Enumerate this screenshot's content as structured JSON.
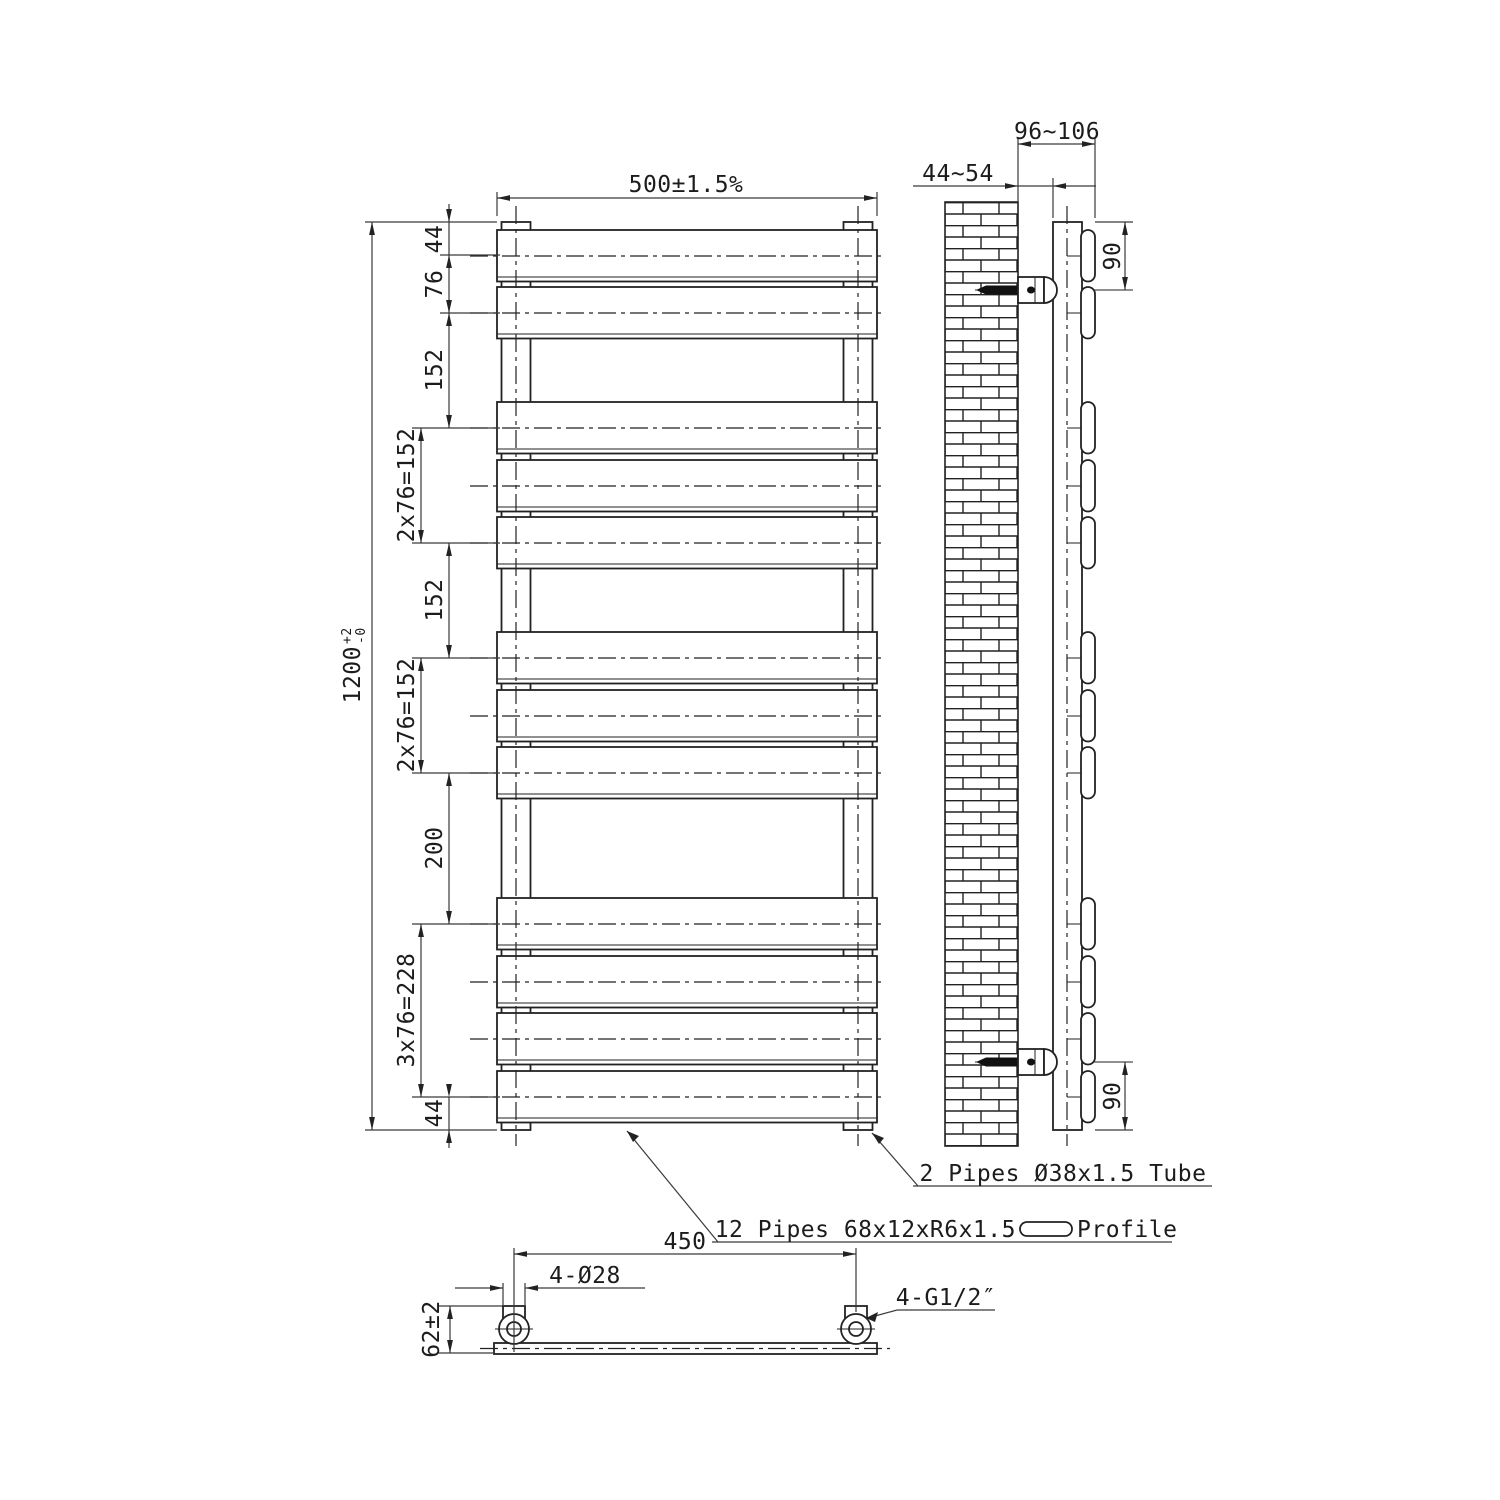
{
  "drawing": {
    "front_view": {
      "dim_width": "500±1.5%",
      "dim_height": "1200",
      "dim_height_tol_upper": "+2",
      "dim_height_tol_lower": "-0",
      "dim_chain": [
        "44",
        "76",
        "152",
        "2x76=152",
        "152",
        "2x76=152",
        "200",
        "3x76=228",
        "44"
      ]
    },
    "side_view": {
      "dim_wall_to_tube": "44~54",
      "dim_wall_to_front": "96~106",
      "dim_bracket_top": "90",
      "dim_bracket_bottom": "90"
    },
    "plan_view": {
      "dim_centers": "450",
      "dim_connections": "4-Ø28",
      "dim_thread": "4-G1/2″",
      "dim_depth": "62±2"
    },
    "callouts": {
      "vertical_tubes": "2 Pipes Ø38x1.5 Tube",
      "flat_panels": "12 Pipes 68x12xR6x1.5",
      "flat_panels_suffix": "Profile"
    },
    "colors": {
      "line": "#222222",
      "dim": "#3a3a3a",
      "background": "#ffffff"
    }
  }
}
